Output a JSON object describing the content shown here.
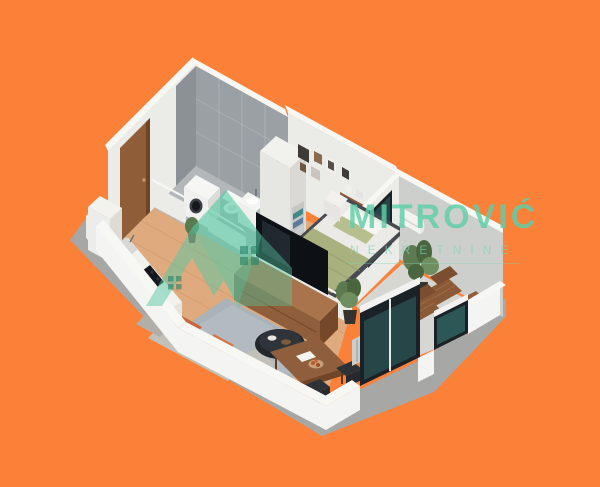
{
  "watermark": {
    "brand": "MITROVIĆ",
    "subtitle": "NEKRETNINE"
  },
  "scene": {
    "type": "isometric-3d-floorplan-render",
    "rooms": [
      "bathroom",
      "hallway",
      "kitchen",
      "living-room",
      "bedroom",
      "balcony"
    ],
    "furniture": [
      "washing-machine",
      "toilet",
      "sink-vanity",
      "shower",
      "entrance-door",
      "wardrobe",
      "towel-niche",
      "bed",
      "nightstand",
      "picture-frames",
      "wall-shelf",
      "ac-unit",
      "tv",
      "tv-console",
      "rug",
      "coffee-table",
      "sofa",
      "dining-table",
      "dining-chairs",
      "radiator",
      "kitchen-counter",
      "cooktop",
      "kitchen-sink",
      "fridge-cabinet",
      "potted-plants",
      "lounge-chairs",
      "balcony-side-table",
      "glass-sliding-doors",
      "glass-balustrade"
    ]
  },
  "colors": {
    "bg": "#fb8138",
    "shadow": "#a7a7a5",
    "wallTop": "#f7f7f4",
    "wallFace": "#ebebe7",
    "wallFaceDark": "#dededa",
    "wallGray": "#cdcfcc",
    "tile": "#9aa0a4",
    "tileDark": "#8b9196",
    "tileFloor": "#b3b7ba",
    "wood": "#dfab7e",
    "woodLine": "#c98f62",
    "balconyFloor": "#d6d6d2",
    "counterTop": "#f1f1ee",
    "counterFace": "#e3e3e0",
    "cooktop": "#14171b",
    "door": "#8f5d38",
    "doorDark": "#6e4426",
    "sofa": "#c3c0b9",
    "sofaDark": "#b2afa9",
    "pillow": "#c9653a",
    "rug": "#aab3ba",
    "rugLight": "#b9c1c7",
    "tvBlack": "#0d1115",
    "consoleWood": "#a9744b",
    "consoleWoodDark": "#8f5e3b",
    "tableWood": "#8e5e3d",
    "chairDark": "#2e3236",
    "bedWhite": "#eceae6",
    "bedGreen": "#a9b17f",
    "pillowGreen": "#b7bf8e",
    "bedFrame": "#474b4f",
    "shelfWood": "#8a5a38",
    "plant": "#5c7a50",
    "plantDark": "#49663f",
    "pot": "#35332f",
    "lounger": "#8a5a38",
    "loungerDark": "#7c4e30",
    "glass": "#1a2228",
    "glassTeal": "#3f8a84",
    "radiator": "#c9cdcb",
    "towel1": "#3f8a8c",
    "towel2": "#5a7b9c",
    "towel3": "#2e6f72",
    "watermark": "#5ecfa9",
    "watermarkSub": "#7ad6b4"
  }
}
